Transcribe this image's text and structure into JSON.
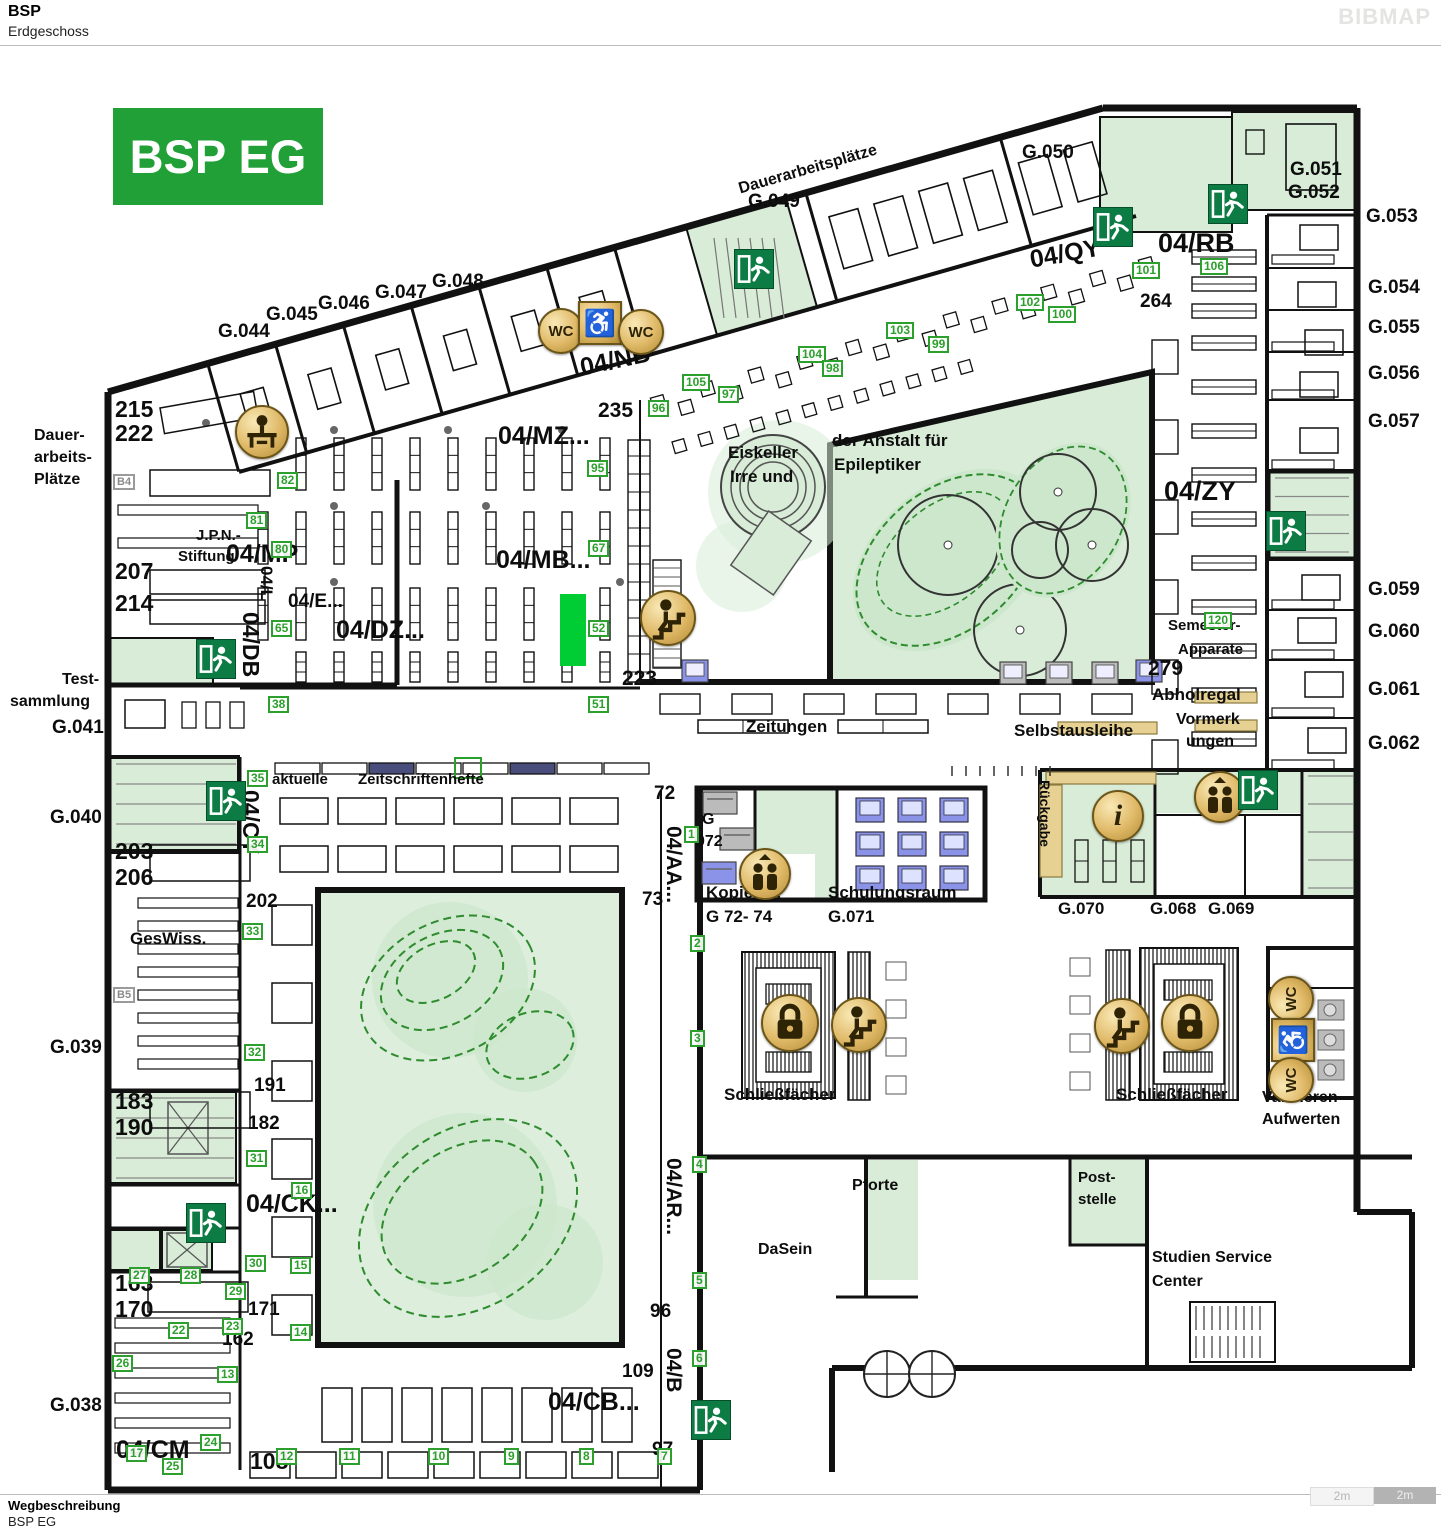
{
  "header": {
    "title": "BSP",
    "subtitle": "Erdgeschoss",
    "brand": "BIBMAP"
  },
  "footer": {
    "title": "Wegbeschreibung",
    "subtitle": "BSP EG"
  },
  "scale_bar": {
    "segments": [
      "2m",
      "2m"
    ]
  },
  "badge": "BSP EG",
  "colors": {
    "badge_green": "#22a038",
    "marker_green": "#2ca02c",
    "room_green": "#d8ecd8",
    "courtyard_green": "#ddeedd",
    "highlight_green": "#00cc33",
    "exit_green": "#0c7c44",
    "gold": "#dfb866",
    "tan": "#e6d192",
    "navy": "#4a4e7c",
    "pc_blue": "#8a93e8"
  },
  "map": {
    "labels": [
      {
        "t": "G.044",
        "x": 218,
        "y": 322,
        "s": 19
      },
      {
        "t": "G.045",
        "x": 266,
        "y": 305,
        "s": 19
      },
      {
        "t": "G.046",
        "x": 318,
        "y": 294,
        "s": 19
      },
      {
        "t": "G.047",
        "x": 375,
        "y": 283,
        "s": 19
      },
      {
        "t": "G.048",
        "x": 432,
        "y": 272,
        "s": 19
      },
      {
        "t": "G.049",
        "x": 748,
        "y": 192,
        "s": 19
      },
      {
        "t": "Dauerarbeitsplätze",
        "x": 737,
        "y": 182,
        "s": 16,
        "r": -16
      },
      {
        "t": "G.050",
        "x": 1022,
        "y": 143,
        "s": 19
      },
      {
        "t": "G.051",
        "x": 1290,
        "y": 160,
        "s": 19
      },
      {
        "t": "G.052",
        "x": 1288,
        "y": 183,
        "s": 19
      },
      {
        "t": "G.053",
        "x": 1366,
        "y": 207,
        "s": 19
      },
      {
        "t": "G.054",
        "x": 1368,
        "y": 278,
        "s": 19
      },
      {
        "t": "G.055",
        "x": 1368,
        "y": 318,
        "s": 19
      },
      {
        "t": "G.056",
        "x": 1368,
        "y": 364,
        "s": 19
      },
      {
        "t": "G.057",
        "x": 1368,
        "y": 412,
        "s": 19
      },
      {
        "t": "G.059",
        "x": 1368,
        "y": 580,
        "s": 19
      },
      {
        "t": "G.060",
        "x": 1368,
        "y": 622,
        "s": 19
      },
      {
        "t": "G.061",
        "x": 1368,
        "y": 680,
        "s": 19
      },
      {
        "t": "G.062",
        "x": 1368,
        "y": 734,
        "s": 19
      },
      {
        "t": "215",
        "x": 115,
        "y": 398,
        "s": 23
      },
      {
        "t": "222",
        "x": 115,
        "y": 422,
        "s": 23
      },
      {
        "t": "Dauer-",
        "x": 34,
        "y": 428,
        "s": 16
      },
      {
        "t": "arbeits-",
        "x": 34,
        "y": 450,
        "s": 16
      },
      {
        "t": "Plätze",
        "x": 34,
        "y": 472,
        "s": 16
      },
      {
        "t": "J.P.N.-",
        "x": 196,
        "y": 528,
        "s": 15
      },
      {
        "t": "Stiftung",
        "x": 178,
        "y": 549,
        "s": 15
      },
      {
        "t": "207",
        "x": 115,
        "y": 560,
        "s": 23
      },
      {
        "t": "214",
        "x": 115,
        "y": 592,
        "s": 23
      },
      {
        "t": "Test-",
        "x": 62,
        "y": 672,
        "s": 16
      },
      {
        "t": "sammlung",
        "x": 10,
        "y": 694,
        "s": 16
      },
      {
        "t": "G.041",
        "x": 52,
        "y": 718,
        "s": 19
      },
      {
        "t": "G.040",
        "x": 50,
        "y": 808,
        "s": 19
      },
      {
        "t": "203",
        "x": 115,
        "y": 840,
        "s": 23
      },
      {
        "t": "206",
        "x": 115,
        "y": 866,
        "s": 23
      },
      {
        "t": "GesWiss.",
        "x": 130,
        "y": 930,
        "s": 17
      },
      {
        "t": "G.039",
        "x": 50,
        "y": 1038,
        "s": 19
      },
      {
        "t": "183",
        "x": 115,
        "y": 1090,
        "s": 23
      },
      {
        "t": "190",
        "x": 115,
        "y": 1116,
        "s": 23
      },
      {
        "t": "163",
        "x": 115,
        "y": 1272,
        "s": 23
      },
      {
        "t": "170",
        "x": 115,
        "y": 1298,
        "s": 23
      },
      {
        "t": "G.038",
        "x": 50,
        "y": 1396,
        "s": 19
      },
      {
        "t": "202",
        "x": 246,
        "y": 892,
        "s": 19
      },
      {
        "t": "191",
        "x": 254,
        "y": 1076,
        "s": 19
      },
      {
        "t": "182",
        "x": 248,
        "y": 1114,
        "s": 19
      },
      {
        "t": "171",
        "x": 248,
        "y": 1300,
        "s": 19
      },
      {
        "t": "162",
        "x": 222,
        "y": 1330,
        "s": 19
      },
      {
        "t": "04/CM",
        "x": 116,
        "y": 1438,
        "s": 25
      },
      {
        "t": "108",
        "x": 250,
        "y": 1450,
        "s": 23
      },
      {
        "t": "04/CB...",
        "x": 548,
        "y": 1390,
        "s": 25
      },
      {
        "t": "109",
        "x": 622,
        "y": 1362,
        "s": 19
      },
      {
        "t": "96",
        "x": 650,
        "y": 1302,
        "s": 19
      },
      {
        "t": "97",
        "x": 652,
        "y": 1440,
        "s": 19
      },
      {
        "t": "04/MP",
        "x": 226,
        "y": 542,
        "s": 25
      },
      {
        "t": "04/E...",
        "x": 288,
        "y": 592,
        "s": 19
      },
      {
        "t": "04/DZ...",
        "x": 336,
        "y": 618,
        "s": 25
      },
      {
        "t": "04/MZ...",
        "x": 498,
        "y": 424,
        "s": 25
      },
      {
        "t": "04/MB...",
        "x": 496,
        "y": 548,
        "s": 25
      },
      {
        "t": "04/NB",
        "x": 578,
        "y": 356,
        "s": 25,
        "r": -12
      },
      {
        "t": "235",
        "x": 598,
        "y": 400,
        "s": 21
      },
      {
        "t": "223",
        "x": 622,
        "y": 668,
        "s": 21
      },
      {
        "t": "04/QY",
        "x": 1028,
        "y": 248,
        "s": 25,
        "r": -10
      },
      {
        "t": "04/RB",
        "x": 1158,
        "y": 230,
        "s": 27
      },
      {
        "t": "264",
        "x": 1140,
        "y": 292,
        "s": 19
      },
      {
        "t": "04/ZY",
        "x": 1164,
        "y": 478,
        "s": 27
      },
      {
        "t": "Eiskeller",
        "x": 728,
        "y": 444,
        "s": 17
      },
      {
        "t": "Irre und",
        "x": 730,
        "y": 468,
        "s": 17
      },
      {
        "t": "der Anstalt für",
        "x": 832,
        "y": 432,
        "s": 17
      },
      {
        "t": "Epileptiker",
        "x": 834,
        "y": 456,
        "s": 17
      },
      {
        "t": "Zeitungen",
        "x": 746,
        "y": 718,
        "s": 17
      },
      {
        "t": "Selbstausleihe",
        "x": 1014,
        "y": 722,
        "s": 17
      },
      {
        "t": "Abholregal",
        "x": 1152,
        "y": 686,
        "s": 17
      },
      {
        "t": "Vormerk",
        "x": 1176,
        "y": 712,
        "s": 16
      },
      {
        "t": "ungen",
        "x": 1186,
        "y": 734,
        "s": 16
      },
      {
        "t": "279",
        "x": 1148,
        "y": 658,
        "s": 21
      },
      {
        "t": "Semester-",
        "x": 1168,
        "y": 618,
        "s": 15
      },
      {
        "t": "Apparate",
        "x": 1178,
        "y": 642,
        "s": 15
      },
      {
        "t": "aktuelle",
        "x": 272,
        "y": 772,
        "s": 15
      },
      {
        "t": "Zeitschriftenhefte",
        "x": 358,
        "y": 772,
        "s": 15
      },
      {
        "t": "72",
        "x": 654,
        "y": 784,
        "s": 19
      },
      {
        "t": "73",
        "x": 642,
        "y": 890,
        "s": 19
      },
      {
        "t": "G",
        "x": 702,
        "y": 812,
        "s": 16
      },
      {
        "t": "072",
        "x": 696,
        "y": 834,
        "s": 16
      },
      {
        "t": "Kopierer:",
        "x": 706,
        "y": 884,
        "s": 17
      },
      {
        "t": "G 72- 74",
        "x": 706,
        "y": 908,
        "s": 17
      },
      {
        "t": "Schulungsraum",
        "x": 828,
        "y": 884,
        "s": 17
      },
      {
        "t": "G.071",
        "x": 828,
        "y": 908,
        "s": 17
      },
      {
        "t": "G.070",
        "x": 1058,
        "y": 900,
        "s": 17
      },
      {
        "t": "G.068",
        "x": 1150,
        "y": 900,
        "s": 17
      },
      {
        "t": "G.069",
        "x": 1208,
        "y": 900,
        "s": 17
      },
      {
        "t": "Schließfächer",
        "x": 724,
        "y": 1086,
        "s": 17
      },
      {
        "t": "Schließfächer",
        "x": 1116,
        "y": 1086,
        "s": 17
      },
      {
        "t": "Validieren",
        "x": 1262,
        "y": 1090,
        "s": 16
      },
      {
        "t": "Aufwerten",
        "x": 1262,
        "y": 1112,
        "s": 16
      },
      {
        "t": "Pforte",
        "x": 852,
        "y": 1178,
        "s": 16
      },
      {
        "t": "DaSein",
        "x": 758,
        "y": 1242,
        "s": 16
      },
      {
        "t": "Post-",
        "x": 1078,
        "y": 1170,
        "s": 15
      },
      {
        "t": "stelle",
        "x": 1078,
        "y": 1192,
        "s": 15
      },
      {
        "t": "Studien Service",
        "x": 1152,
        "y": 1250,
        "s": 16
      },
      {
        "t": "Center",
        "x": 1152,
        "y": 1274,
        "s": 16
      },
      {
        "t": "04/CK...",
        "x": 246,
        "y": 1192,
        "s": 25
      },
      {
        "t": "04/L",
        "x": 275,
        "y": 566,
        "s": 17,
        "r": 90
      },
      {
        "t": "04/DB",
        "x": 262,
        "y": 612,
        "s": 23,
        "r": 90
      },
      {
        "t": "04/CY",
        "x": 262,
        "y": 790,
        "s": 23,
        "r": 90
      },
      {
        "t": "04/AA...",
        "x": 684,
        "y": 826,
        "s": 21,
        "r": 90
      },
      {
        "t": "04/AR...",
        "x": 684,
        "y": 1158,
        "s": 21,
        "r": 90
      },
      {
        "t": "04/B",
        "x": 684,
        "y": 1348,
        "s": 21,
        "r": 90
      },
      {
        "t": "Rückgabe",
        "x": 1052,
        "y": 780,
        "s": 14,
        "r": 90
      }
    ],
    "markers": [
      [
        "82",
        277,
        472
      ],
      [
        "81",
        246,
        512
      ],
      [
        "80",
        271,
        541
      ],
      [
        "65",
        271,
        620
      ],
      [
        "38",
        268,
        696
      ],
      [
        "35",
        247,
        770
      ],
      [
        "34",
        247,
        836
      ],
      [
        "33",
        242,
        923
      ],
      [
        "32",
        244,
        1044
      ],
      [
        "31",
        246,
        1150
      ],
      [
        "16",
        291,
        1182
      ],
      [
        "30",
        245,
        1255
      ],
      [
        "15",
        290,
        1257
      ],
      [
        "29",
        225,
        1283
      ],
      [
        "28",
        180,
        1267
      ],
      [
        "27",
        129,
        1267
      ],
      [
        "22",
        168,
        1322
      ],
      [
        "23",
        222,
        1318
      ],
      [
        "26",
        112,
        1355
      ],
      [
        "13",
        217,
        1366
      ],
      [
        "14",
        290,
        1324
      ],
      [
        "24",
        200,
        1434
      ],
      [
        "17",
        126,
        1445
      ],
      [
        "25",
        162,
        1458
      ],
      [
        "12",
        276,
        1448
      ],
      [
        "11",
        339,
        1448
      ],
      [
        "10",
        428,
        1448
      ],
      [
        "9",
        504,
        1448
      ],
      [
        "8",
        579,
        1448
      ],
      [
        "7",
        657,
        1448
      ],
      [
        "6",
        692,
        1350
      ],
      [
        "5",
        692,
        1272
      ],
      [
        "4",
        692,
        1156
      ],
      [
        "3",
        690,
        1030
      ],
      [
        "2",
        690,
        935
      ],
      [
        "1",
        684,
        826
      ],
      [
        "95",
        587,
        460
      ],
      [
        "67",
        588,
        540
      ],
      [
        "52",
        588,
        620
      ],
      [
        "51",
        588,
        696
      ],
      [
        "96",
        648,
        400
      ],
      [
        "97",
        718,
        386
      ],
      [
        "105",
        682,
        374
      ],
      [
        "104",
        798,
        346
      ],
      [
        "98",
        822,
        360
      ],
      [
        "103",
        886,
        322
      ],
      [
        "99",
        928,
        336
      ],
      [
        "102",
        1016,
        294
      ],
      [
        "100",
        1048,
        306
      ],
      [
        "101",
        1132,
        262
      ],
      [
        "106",
        1200,
        258
      ],
      [
        "120",
        1204,
        612
      ]
    ],
    "beacons": [
      [
        "B4",
        113,
        474
      ],
      [
        "B5",
        113,
        987
      ]
    ],
    "icons": [
      {
        "type": "wc-icon",
        "x": 561,
        "y": 331
      },
      {
        "type": "wheelchair-icon",
        "x": 600,
        "y": 323
      },
      {
        "type": "wc-icon",
        "x": 641,
        "y": 332
      },
      {
        "type": "reader-icon",
        "x": 262,
        "y": 432
      },
      {
        "type": "stairs-icon",
        "x": 668,
        "y": 618
      },
      {
        "type": "elevator-icon",
        "x": 765,
        "y": 874
      },
      {
        "type": "lock-icon",
        "x": 790,
        "y": 1023
      },
      {
        "type": "stairs-icon",
        "x": 859,
        "y": 1025
      },
      {
        "type": "stairs-icon",
        "x": 1122,
        "y": 1026
      },
      {
        "type": "lock-icon",
        "x": 1190,
        "y": 1023
      },
      {
        "type": "info-icon",
        "x": 1118,
        "y": 816
      },
      {
        "type": "elevator-icon",
        "x": 1220,
        "y": 797
      },
      {
        "type": "wc-icon",
        "x": 1291,
        "y": 999,
        "rot": -90
      },
      {
        "type": "wheelchair-icon",
        "x": 1293,
        "y": 1040,
        "rot": -90
      },
      {
        "type": "wc-icon",
        "x": 1291,
        "y": 1080,
        "rot": -90
      },
      {
        "type": "exit-icon",
        "x": 753,
        "y": 268
      },
      {
        "type": "exit-icon",
        "x": 1112,
        "y": 226
      },
      {
        "type": "exit-icon",
        "x": 1227,
        "y": 203
      },
      {
        "type": "exit-icon",
        "x": 215,
        "y": 658
      },
      {
        "type": "exit-icon",
        "x": 225,
        "y": 800
      },
      {
        "type": "exit-icon",
        "x": 205,
        "y": 1222
      },
      {
        "type": "exit-icon",
        "x": 1285,
        "y": 530
      },
      {
        "type": "exit-icon",
        "x": 1257,
        "y": 789
      },
      {
        "type": "exit-icon",
        "x": 710,
        "y": 1419
      }
    ],
    "highlight": {
      "x": 560,
      "y": 594,
      "w": 26,
      "h": 72
    }
  }
}
